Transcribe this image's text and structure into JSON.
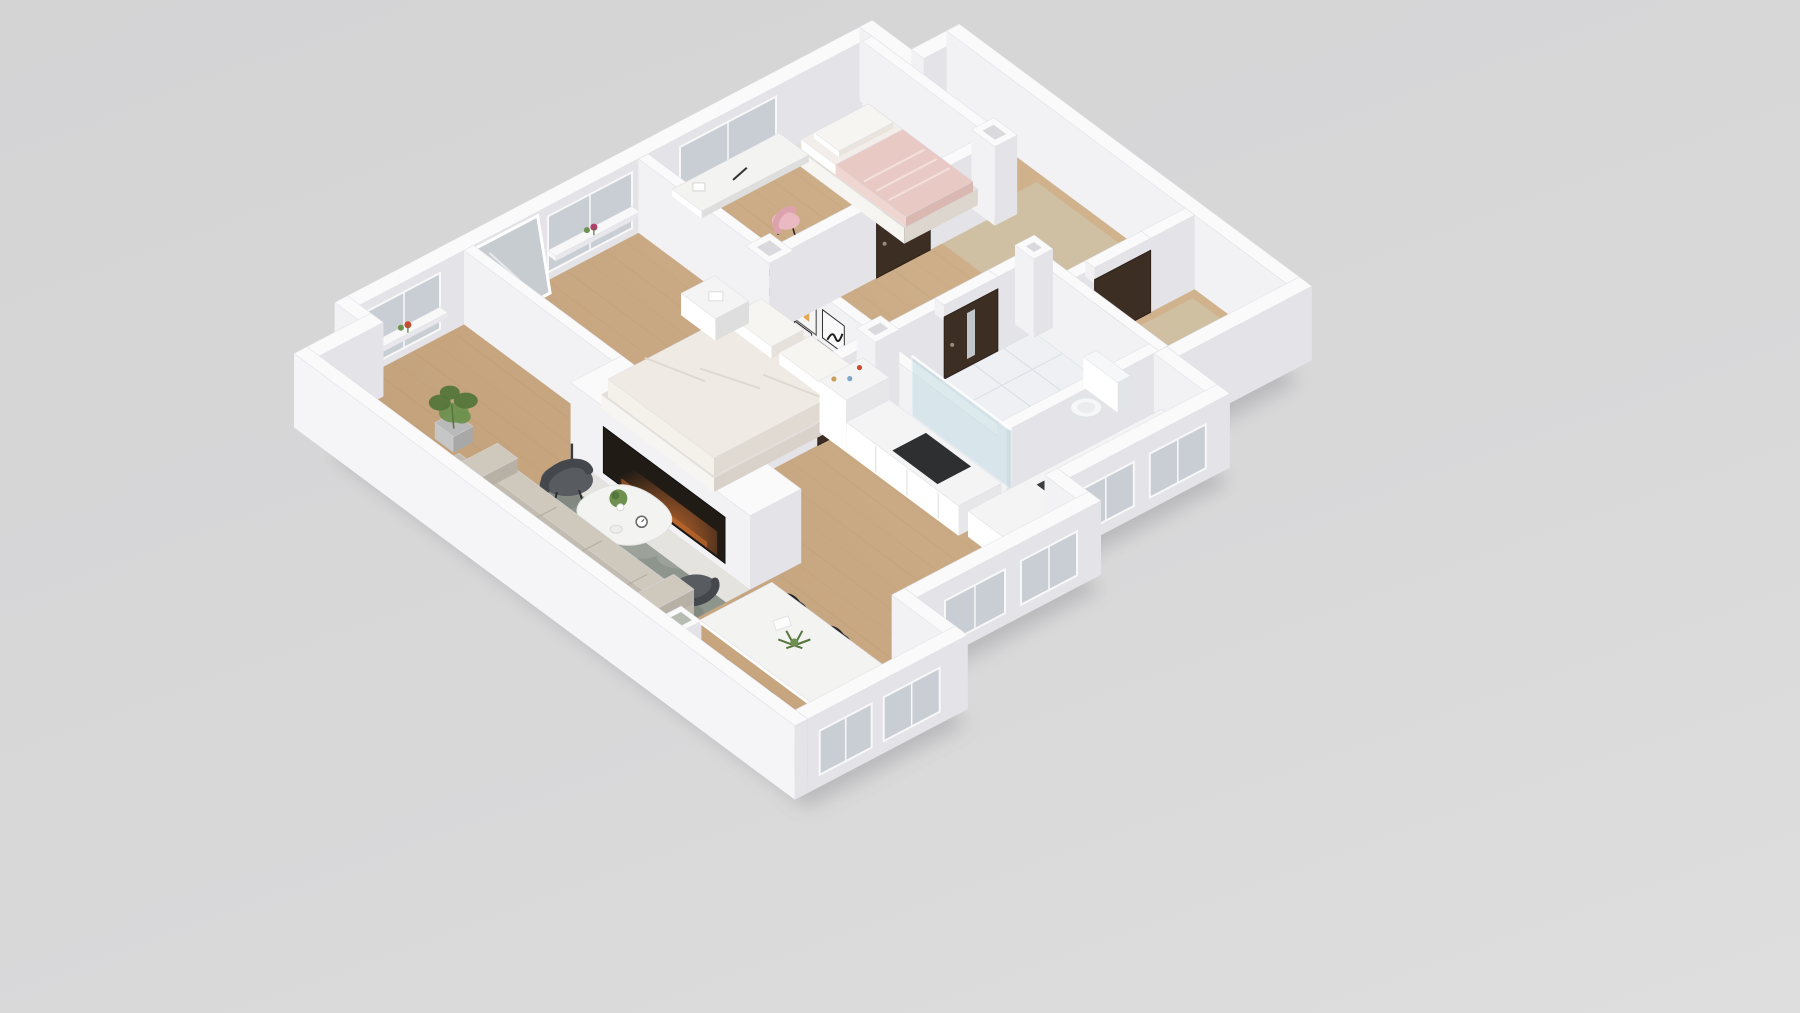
{
  "scene": {
    "kind": "3d-floor-plan-render",
    "view": "isometric dollhouse top-down",
    "background": "#d6d6d7",
    "text_visible": "none"
  },
  "palette": {
    "background": "#d6d6d7",
    "shadow": "#8f8f93",
    "wall_top": "#fafafb",
    "wall_face_light": "#f2f2f4",
    "wall_face_dark": "#e3e3e8",
    "wall_outer_bright": "#f5f5f7",
    "wall_edge": "#dcdce2",
    "floor_wood_light": "#d0b28c",
    "floor_wood_dark": "#c19f79",
    "floor_wood_grain": "#a9885f",
    "floor_tile": "#eef0f3",
    "tile_line": "#d9dee3",
    "entry_carpet": "#cfc1a4",
    "rug_base": "#8e958d",
    "rug_light": "#a9b0a6",
    "rug_dark": "#767d74",
    "sofa": "#cfc8bc",
    "sofa_back": "#c2bbaf",
    "sofa_seam": "#b3ac9f",
    "chair_dark": "#33363a",
    "chair_dark_rim": "#212427",
    "chair_gray": "#585b60",
    "chair_gray_rim": "#44474c",
    "chair_pink": "#eab9c2",
    "table_white": "#f3f3f2",
    "table_side": "#dedede",
    "door_brown": "#3d2e24",
    "door_handle": "#9b8a77",
    "window_glass": "#c9ced4",
    "window_frame": "#f8f8f8",
    "bed_white": "#efeae4",
    "bed_base": "#e4dfd8",
    "bed_fold": "#ded7cf",
    "pillow": "#f7f5f2",
    "kid_bed_pink": "#e9c9c3",
    "kid_sheet": "#f4eeea",
    "fireplace_dark": "#211b16",
    "fire_glow": "#d07030",
    "hearth": "#e9e7e3",
    "counter_white": "#f4f4f5",
    "counter_face": "#e7e7ea",
    "cooktop": "#2d2f31",
    "sink": "#3a3c3f",
    "shower_glass": "#b9d6de",
    "toilet": "#f6f7f8",
    "toilet_shade": "#e2e5e8",
    "sideboard_olive": "#8a8371",
    "sideboard_olive_dark": "#7c7663",
    "plant_green": "#6f9150",
    "plant_dark": "#55763c",
    "pot_gray": "#b9b9b9",
    "art_pink": "#b23e6b",
    "art_orange": "#e0912f",
    "art_black": "#1e1e1e",
    "decor_red": "#cc4a2f",
    "mirror_glass": "#c7ccd1"
  },
  "rooms": [
    {
      "id": "living-room",
      "floor": "wood"
    },
    {
      "id": "dining-area",
      "floor": "wood"
    },
    {
      "id": "kitchen",
      "floor": "wood"
    },
    {
      "id": "hallway",
      "floor": "wood"
    },
    {
      "id": "entry-hall",
      "floor": "carpet-beige"
    },
    {
      "id": "closet",
      "floor": "carpet-beige"
    },
    {
      "id": "master-bedroom",
      "floor": "wood"
    },
    {
      "id": "kids-bedroom",
      "floor": "wood"
    },
    {
      "id": "bathroom",
      "floor": "white-tile"
    }
  ],
  "furniture": [
    {
      "id": "area-rug",
      "room": "living-room",
      "color": "#8e958d"
    },
    {
      "id": "sofa",
      "room": "living-room",
      "color": "#cfc8bc"
    },
    {
      "id": "armchair",
      "room": "living-room",
      "color": "#585b60"
    },
    {
      "id": "lounge-chair",
      "room": "living-room",
      "color": "#585b60"
    },
    {
      "id": "coffee-table",
      "room": "living-room",
      "color": "#f3f3f2"
    },
    {
      "id": "fireplace",
      "room": "living-room",
      "color": "#211b16"
    },
    {
      "id": "candle-holders",
      "room": "living-room",
      "count": 2
    },
    {
      "id": "sideboard",
      "room": "living-room",
      "color": "#8a8371"
    },
    {
      "id": "planter-cubes",
      "room": "living-room",
      "count": 2
    },
    {
      "id": "potted-plants",
      "room": "living-room",
      "count": 2
    },
    {
      "id": "dining-table",
      "room": "dining-area",
      "color": "#f3f3f2"
    },
    {
      "id": "dining-chairs",
      "room": "dining-area",
      "count": 6,
      "color": "#33363a"
    },
    {
      "id": "kitchen-counter",
      "room": "kitchen",
      "color": "#f4f4f5"
    },
    {
      "id": "cooktop",
      "room": "kitchen",
      "color": "#2d2f31"
    },
    {
      "id": "kitchen-sink",
      "room": "kitchen",
      "color": "#3a3c3f"
    },
    {
      "id": "double-bed",
      "room": "master-bedroom",
      "color": "#efeae4"
    },
    {
      "id": "nightstand",
      "room": "master-bedroom",
      "color": "#f4f4f5"
    },
    {
      "id": "wall-mirror",
      "room": "master-bedroom",
      "color": "#c7ccd1"
    },
    {
      "id": "wall-art-gallery",
      "room": "master-bedroom",
      "count": 5
    },
    {
      "id": "single-bed",
      "room": "kids-bedroom",
      "color": "#e9c9c3"
    },
    {
      "id": "desk",
      "room": "kids-bedroom",
      "color": "#f3f3f2"
    },
    {
      "id": "desk-chair",
      "room": "kids-bedroom",
      "color": "#eab9c2"
    },
    {
      "id": "toilet",
      "room": "bathroom",
      "color": "#f6f7f8"
    },
    {
      "id": "shower-screen",
      "room": "bathroom",
      "color": "#b9d6de"
    },
    {
      "id": "window-flowers",
      "room": "living-room",
      "count": 3
    }
  ],
  "doors": {
    "count": 4,
    "color": "#3d2e24"
  },
  "windows": {
    "count": 9,
    "color": "#c9ced4"
  }
}
